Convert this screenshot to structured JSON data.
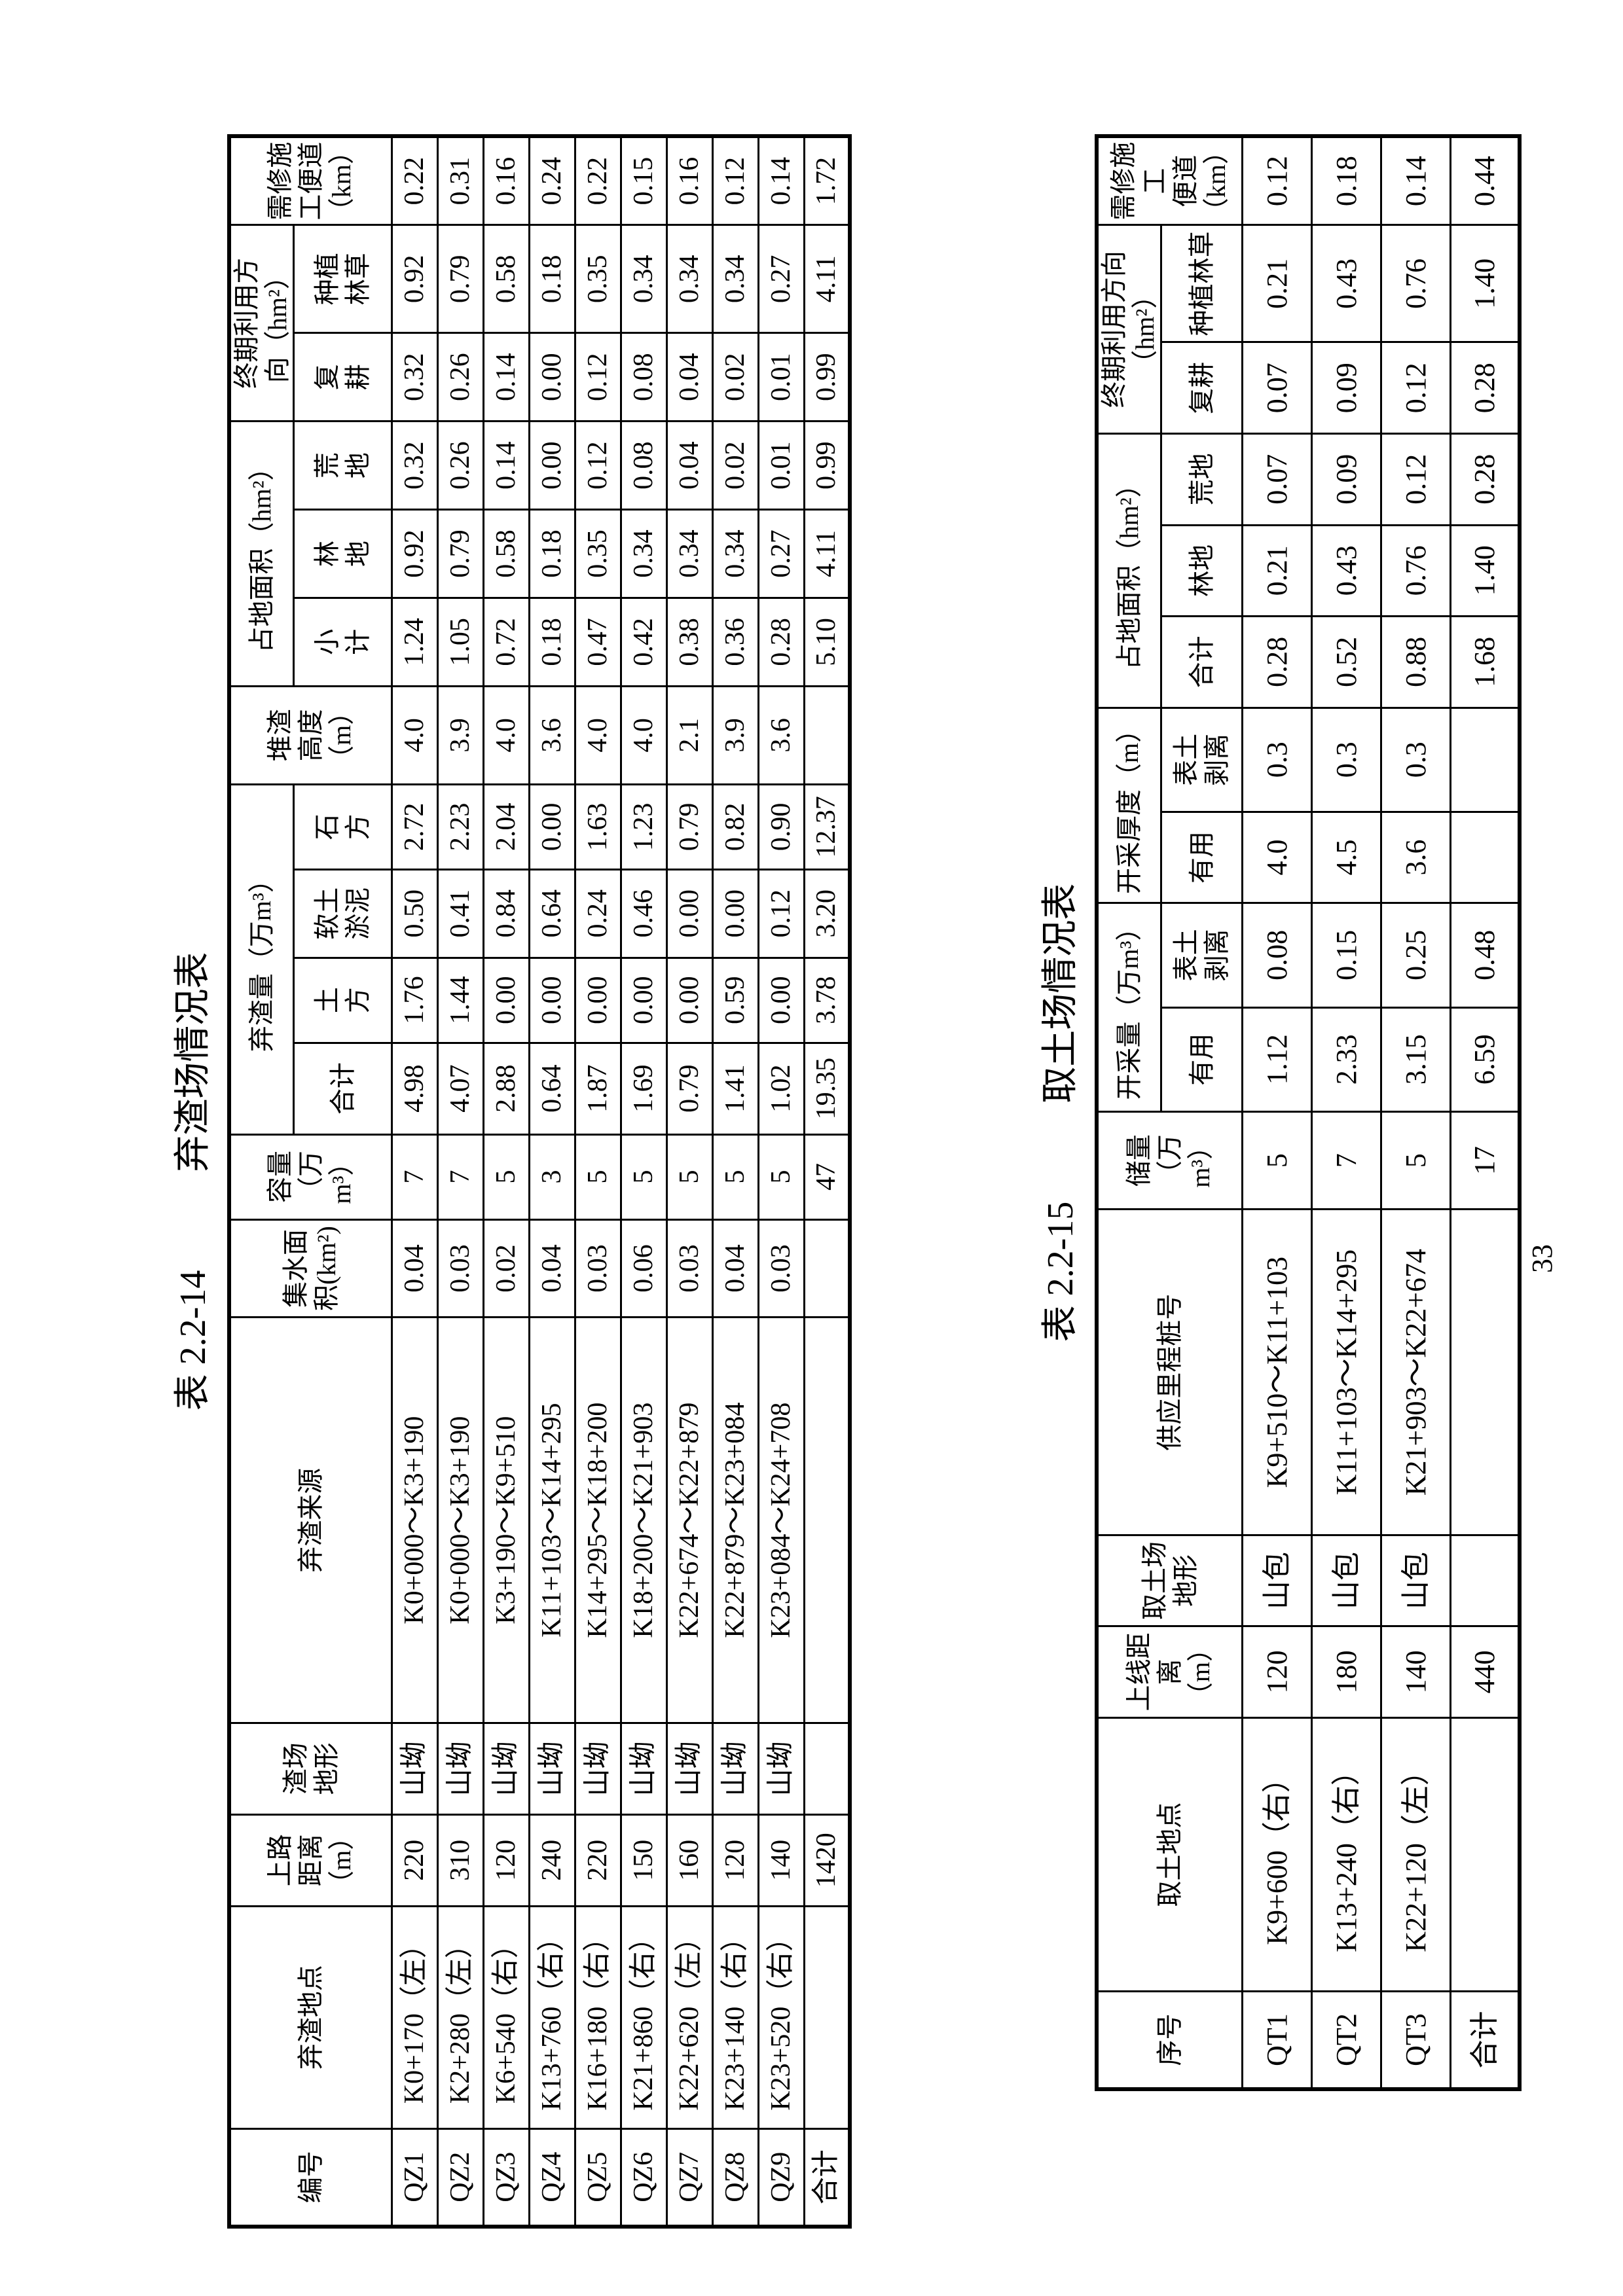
{
  "page_number": "33",
  "table1": {
    "label": "表 2.2-14",
    "title": "弃渣场情况表",
    "headers": {
      "id": "编号",
      "location": "弃渣地点",
      "road_distance": "上路\n距离\n（m）",
      "terrain": "渣场\n地形",
      "source": "弃渣来源",
      "catchment": "集水面\n积(km²)",
      "capacity": "容量\n（万\nm³）",
      "volume_group": "弃渣量（万m³）",
      "volume_total": "合计",
      "earthwork": "土\n方",
      "soft_soil": "软土\n淤泥",
      "rockwork": "石\n方",
      "pile_height": "堆渣\n高度\n（m）",
      "area_group": "占地面积（hm²）",
      "area_subtotal": "小\n计",
      "forest_land": "林\n地",
      "waste_land": "荒\n地",
      "reuse_group": "终期利用方\n向（hm²）",
      "recultivation": "复\n耕",
      "planting": "种植\n林草",
      "access_road": "需修施\n工便道\n（km）"
    },
    "rows": [
      [
        "QZ1",
        "K0+170（左）",
        "220",
        "山坳",
        "K0+000～K3+190",
        "0.04",
        "7",
        "4.98",
        "1.76",
        "0.50",
        "2.72",
        "4.0",
        "1.24",
        "0.92",
        "0.32",
        "0.32",
        "0.92",
        "0.22"
      ],
      [
        "QZ2",
        "K2+280（左）",
        "310",
        "山坳",
        "K0+000～K3+190",
        "0.03",
        "7",
        "4.07",
        "1.44",
        "0.41",
        "2.23",
        "3.9",
        "1.05",
        "0.79",
        "0.26",
        "0.26",
        "0.79",
        "0.31"
      ],
      [
        "QZ3",
        "K6+540（右）",
        "120",
        "山坳",
        "K3+190～K9+510",
        "0.02",
        "5",
        "2.88",
        "0.00",
        "0.84",
        "2.04",
        "4.0",
        "0.72",
        "0.58",
        "0.14",
        "0.14",
        "0.58",
        "0.16"
      ],
      [
        "QZ4",
        "K13+760（右）",
        "240",
        "山坳",
        "K11+103～K14+295",
        "0.04",
        "3",
        "0.64",
        "0.00",
        "0.64",
        "0.00",
        "3.6",
        "0.18",
        "0.18",
        "0.00",
        "0.00",
        "0.18",
        "0.24"
      ],
      [
        "QZ5",
        "K16+180（右）",
        "220",
        "山坳",
        "K14+295～K18+200",
        "0.03",
        "5",
        "1.87",
        "0.00",
        "0.24",
        "1.63",
        "4.0",
        "0.47",
        "0.35",
        "0.12",
        "0.12",
        "0.35",
        "0.22"
      ],
      [
        "QZ6",
        "K21+860（右）",
        "150",
        "山坳",
        "K18+200～K21+903",
        "0.06",
        "5",
        "1.69",
        "0.00",
        "0.46",
        "1.23",
        "4.0",
        "0.42",
        "0.34",
        "0.08",
        "0.08",
        "0.34",
        "0.15"
      ],
      [
        "QZ7",
        "K22+620（左）",
        "160",
        "山坳",
        "K22+674～K22+879",
        "0.03",
        "5",
        "0.79",
        "0.00",
        "0.00",
        "0.79",
        "2.1",
        "0.38",
        "0.34",
        "0.04",
        "0.04",
        "0.34",
        "0.16"
      ],
      [
        "QZ8",
        "K23+140（右）",
        "120",
        "山坳",
        "K22+879～K23+084",
        "0.04",
        "5",
        "1.41",
        "0.59",
        "0.00",
        "0.82",
        "3.9",
        "0.36",
        "0.34",
        "0.02",
        "0.02",
        "0.34",
        "0.12"
      ],
      [
        "QZ9",
        "K23+520（右）",
        "140",
        "山坳",
        "K23+084～K24+708",
        "0.03",
        "5",
        "1.02",
        "0.00",
        "0.12",
        "0.90",
        "3.6",
        "0.28",
        "0.27",
        "0.01",
        "0.01",
        "0.27",
        "0.14"
      ],
      [
        "合计",
        "",
        "1420",
        "",
        "",
        "",
        "47",
        "19.35",
        "3.78",
        "3.20",
        "12.37",
        "",
        "5.10",
        "4.11",
        "0.99",
        "0.99",
        "4.11",
        "1.72"
      ]
    ]
  },
  "table2": {
    "label": "表 2.2-15",
    "title": "取土场情况表",
    "headers": {
      "id": "序号",
      "location": "取土地点",
      "line_distance": "上线距\n离\n（m）",
      "terrain": "取土场\n地形",
      "supply_range": "供应里程桩号",
      "reserve": "储量\n（万\nm³）",
      "mining_group": "开采量（万m³）",
      "mining_useful": "有用",
      "mining_stripping": "表土\n剥离",
      "thickness_group": "开采厚度（m）",
      "thickness_useful": "有用",
      "thickness_stripping": "表土\n剥离",
      "area_group": "占地面积（hm²）",
      "area_total": "合计",
      "forest_land": "林地",
      "waste_land": "荒地",
      "reuse_group": "终期利用方向\n（hm²）",
      "recultivation": "复耕",
      "planting": "种植林草",
      "access_road": "需修施工\n便道（km）"
    },
    "rows": [
      [
        "QT1",
        "K9+600（右）",
        "120",
        "山包",
        "K9+510～K11+103",
        "5",
        "1.12",
        "0.08",
        "4.0",
        "0.3",
        "0.28",
        "0.21",
        "0.07",
        "0.07",
        "0.21",
        "0.12"
      ],
      [
        "QT2",
        "K13+240（右）",
        "180",
        "山包",
        "K11+103～K14+295",
        "7",
        "2.33",
        "0.15",
        "4.5",
        "0.3",
        "0.52",
        "0.43",
        "0.09",
        "0.09",
        "0.43",
        "0.18"
      ],
      [
        "QT3",
        "K22+120（左）",
        "140",
        "山包",
        "K21+903～K22+674",
        "5",
        "3.15",
        "0.25",
        "3.6",
        "0.3",
        "0.88",
        "0.76",
        "0.12",
        "0.12",
        "0.76",
        "0.14"
      ],
      [
        "合计",
        "",
        "440",
        "",
        "",
        "17",
        "6.59",
        "0.48",
        "",
        "",
        "1.68",
        "1.40",
        "0.28",
        "0.28",
        "1.40",
        "0.44"
      ]
    ]
  }
}
